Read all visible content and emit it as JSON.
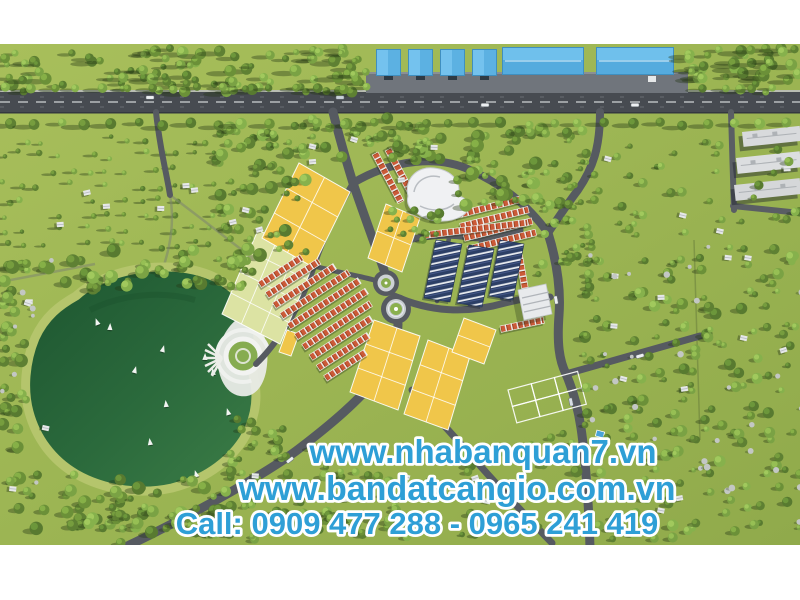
{
  "image": {
    "alt": "Aerial 3D master plan render of a residential land project beside a green lake, with industrial warehouses along a main road and subdivided yellow land plots",
    "kind": "real-estate advertisement render"
  },
  "overlay": {
    "website_primary": "www.nhabanquan7.vn",
    "website_secondary": "www.bandatcangio.com.vn",
    "call_line": "Call: 0909 477 288 - 0965 241 419"
  },
  "colors": {
    "text_blue": "#2E9FD6",
    "text_outline": "#FFFFFF",
    "field_green_light": "#A6BD58",
    "field_green": "#97B14E",
    "tree_green": "#5E8033",
    "water_dark": "#1F5830",
    "water_light": "#3A7A45",
    "shore": "#B5C56C",
    "road_gray": "#565A61",
    "main_road": "#474B51",
    "plot_yellow": "#F0C64A",
    "plot_pale": "#DCE3A3",
    "roof_orange": "#CB5A38",
    "roof_navy": "#2C3F66",
    "warehouse_blue": "#5CB1E2",
    "building_white": "#E6E8E9"
  }
}
